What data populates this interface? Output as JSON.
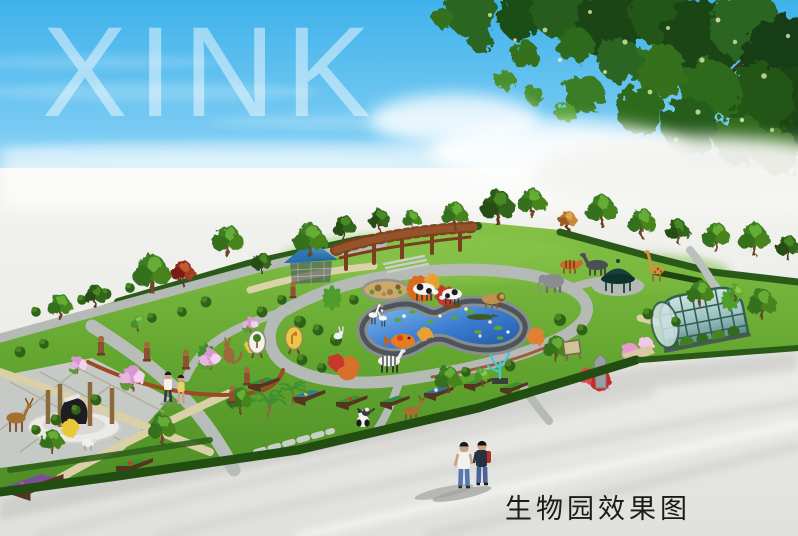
{
  "watermark": {
    "text": "XINK"
  },
  "caption": {
    "text": "生物园效果图"
  },
  "palette": {
    "sky_blue": "#44b5ec",
    "ground_white": "#efefec",
    "lawn_green": "#61a42e",
    "hedge_green": "#2a5717",
    "path_gray": "#b5bab6",
    "path_tan": "#d9d0a7",
    "pond_blue": "#2e6ec6",
    "pergola_brown": "#8a4a22",
    "greenhouse_teal": "#9fc3c9",
    "tent_blue": "#2f85c8",
    "caption_black": "#1b1b1b"
  }
}
